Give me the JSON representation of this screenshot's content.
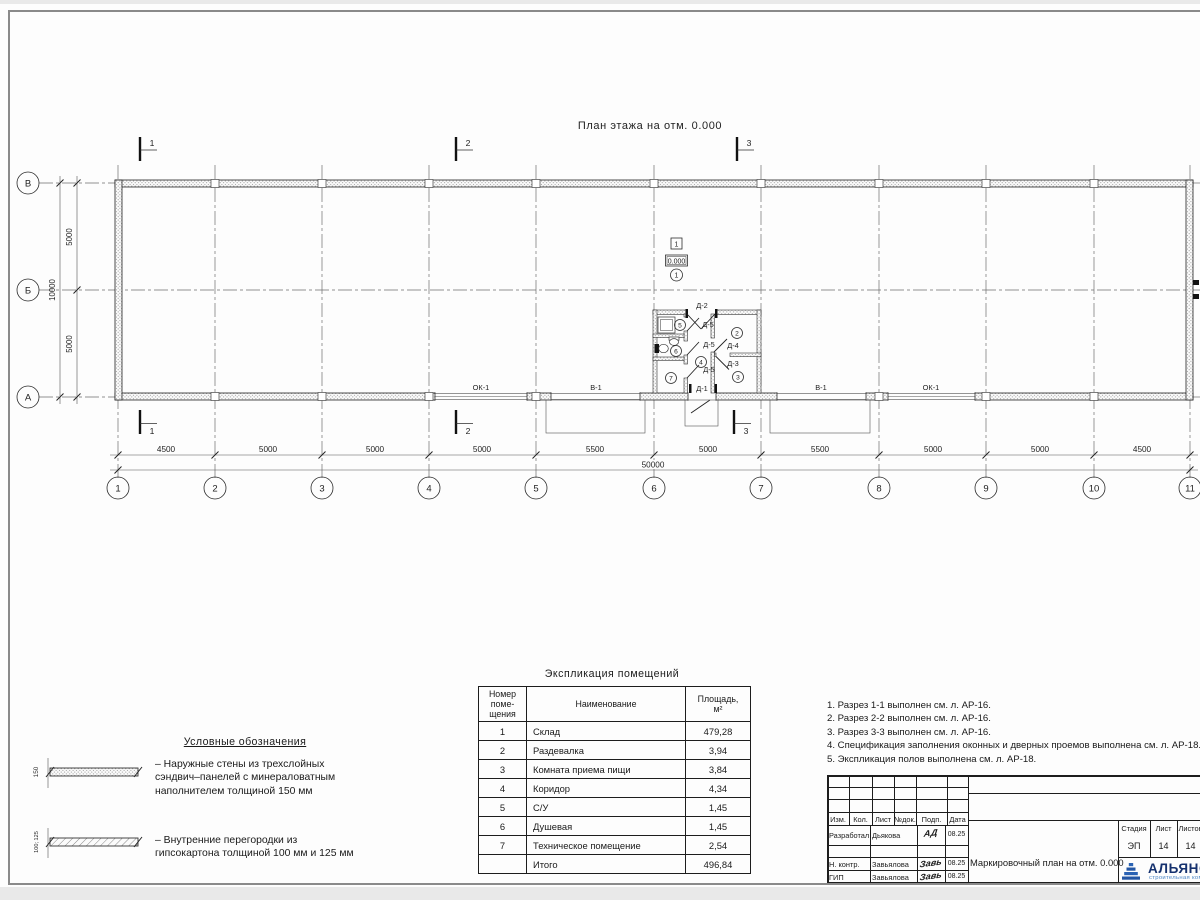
{
  "plan": {
    "title": "План этажа на отм. 0.000",
    "grid_cols": [
      "1",
      "2",
      "3",
      "4",
      "5",
      "6",
      "7",
      "8",
      "9",
      "10",
      "11"
    ],
    "grid_rows": [
      "В",
      "Б",
      "А"
    ],
    "dims_bottom": [
      "4500",
      "5000",
      "5000",
      "5000",
      "5500",
      "5000",
      "5500",
      "5000",
      "5000",
      "4500"
    ],
    "dim_total": "50000",
    "dims_left": [
      "5000",
      "5000"
    ],
    "dim_left_total": "10000",
    "sections": [
      "1",
      "2",
      "3"
    ],
    "window_label": "ОК-1",
    "gate_label": "В-1",
    "doors": {
      "d1": "Д-1",
      "d2": "Д-2",
      "d3": "Д-3",
      "d4": "Д-4",
      "d5": "Д-5"
    },
    "rooms": [
      "1",
      "2",
      "3",
      "4",
      "5",
      "6",
      "7"
    ],
    "level": {
      "opening": "1",
      "elevation": "0.000",
      "room": "1"
    }
  },
  "legend": {
    "title": "Условные обозначения",
    "items": [
      {
        "dim": "150",
        "text": "–  Наружные стены из трехслойных\nсэндвич–панелей с минераловатным\nнаполнителем толщиной 150 мм"
      },
      {
        "dim": "100; 125",
        "text": "–  Внутренние перегородки из\nгипсокартона толщиной 100 мм и 125 мм"
      }
    ]
  },
  "schedule": {
    "title": "Экспликация  помещений",
    "headers": [
      "Номер\nпоме-\nщения",
      "Наименование",
      "Площадь,\nм²"
    ],
    "rows": [
      [
        "1",
        "Склад",
        "479,28"
      ],
      [
        "2",
        "Раздевалка",
        "3,94"
      ],
      [
        "3",
        "Комната приема пищи",
        "3,84"
      ],
      [
        "4",
        "Коридор",
        "4,34"
      ],
      [
        "5",
        "С/У",
        "1,45"
      ],
      [
        "6",
        "Душевая",
        "1,45"
      ],
      [
        "7",
        "Техническое помещение",
        "2,54"
      ]
    ],
    "total": [
      "",
      "Итого",
      "496,84"
    ]
  },
  "notes": [
    "1. Разрез 1-1 выполнен см. л. АР-16.",
    "2. Разрез 2-2 выполнен см. л. АР-16.",
    "3. Разрез 3-3 выполнен см. л. АР-16.",
    "4. Спецификация заполнения оконных и дверных проемов выполнена см. л. АР-18.",
    "5. Экспликация полов выполнена см. л. АР-18."
  ],
  "titleblock": {
    "cols": [
      "Изм.",
      "Кол.",
      "Лист",
      "№док.",
      "Подп.",
      "Дата"
    ],
    "staff": [
      {
        "role": "Разработал",
        "name": "Дьякова",
        "sig": "АД",
        "date": "08.25"
      },
      {
        "role": "Н. контр.",
        "name": "Завьялова",
        "sig": "Завь",
        "date": "08.25"
      },
      {
        "role": "ГИП",
        "name": "Завьялова",
        "sig": "Завь",
        "date": "08.25"
      }
    ],
    "doc_title": "Маркировочный план на отм. 0.000",
    "stage_label": "Стадия",
    "sheet_label": "Лист",
    "sheets_label": "Листов",
    "stage": "ЭП",
    "sheet": "14",
    "sheets": "14",
    "logo": {
      "name": "АЛЬЯНС",
      "subtitle": "строительная компания",
      "accent": "#2456a4",
      "text_color": "#15316e",
      "subtitle_color": "#4c86c6"
    }
  }
}
